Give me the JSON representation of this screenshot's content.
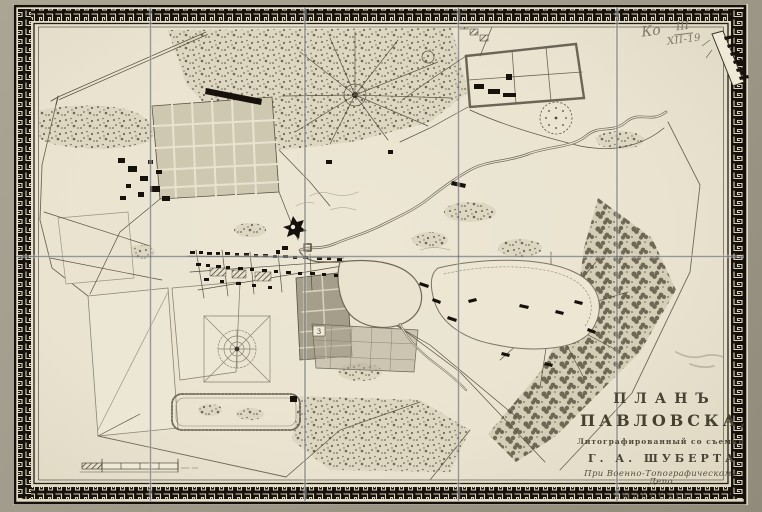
{
  "sheet": {
    "kind": "lithographed-map-scan",
    "title_block": {
      "plan_word": "ПЛАНЪ",
      "place_word": "ПАВЛОВСКА,",
      "subtitle": "Литографированный со съемки",
      "author": "Г. А. ШУБЕРТА",
      "publisher": "При Военно-Топографическомъ Депо",
      "year_roman": "MDCCCXLII."
    },
    "handwritten_mark": {
      "prefix": "Ко",
      "numerator": "III",
      "denominator": "XII-19"
    },
    "map_labels": {
      "plot_number": "3"
    },
    "colors": {
      "backdrop": "#a29c8c",
      "paper": "#ebe5d3",
      "ink": "#4a4437",
      "building_black": "#16110b",
      "block_grey": "#a59e8a",
      "fold_line": "#4a5662",
      "pencil": "#7e7767",
      "border_black": "#16110b"
    }
  }
}
